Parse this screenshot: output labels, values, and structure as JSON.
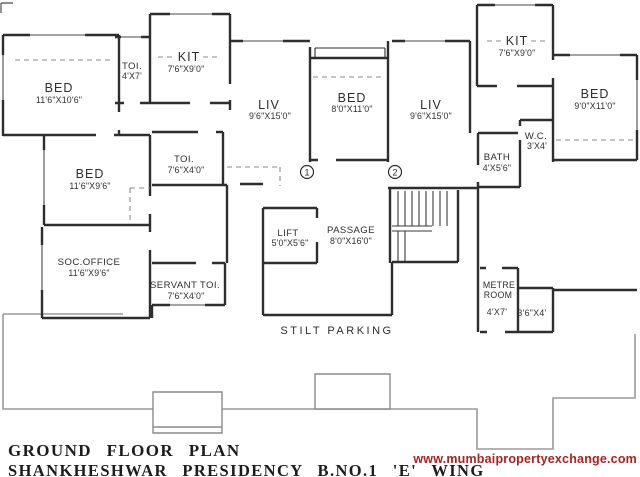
{
  "plan": {
    "rooms": {
      "bed_top_left": {
        "name": "BED",
        "dims": "11'6\"X10'6\""
      },
      "toi_top_left": {
        "name": "TOI.",
        "dims": "4'X7'"
      },
      "kitchen_left": {
        "name": "KIT",
        "dims": "7'6\"X9'0\""
      },
      "living_left": {
        "name": "LIV",
        "dims": "9'6\"X15'0\""
      },
      "bed_mid": {
        "name": "BED",
        "dims": "8'0\"X11'0\""
      },
      "living_right": {
        "name": "LIV",
        "dims": "9'6\"X15'0\""
      },
      "kitchen_right": {
        "name": "KIT",
        "dims": "7'6\"X9'0\""
      },
      "bed_right": {
        "name": "BED",
        "dims": "9'0\"X11'0\""
      },
      "wc": {
        "name": "W.C.",
        "dims": "3'X4'"
      },
      "bath": {
        "name": "BATH",
        "dims": "4'X5'6\""
      },
      "bed_left": {
        "name": "BED",
        "dims": "11'6\"X9'6\""
      },
      "toi_mid": {
        "name": "TOI.",
        "dims": "7'6\"X4'0\""
      },
      "soc_office": {
        "name": "SOC.OFFICE",
        "dims": "11'6\"X9'6\""
      },
      "servant_toi": {
        "name": "SERVANT TOI.",
        "dims": "7'6\"X4'0\""
      },
      "lift": {
        "name": "LIFT",
        "dims": "5'0\"X5'6\""
      },
      "passage": {
        "name": "PASSAGE",
        "dims": "8'0\"X16'0\""
      },
      "metre_room": {
        "name_line1": "METRE",
        "name_line2": "ROOM",
        "dims": "4'X7'"
      },
      "store": {
        "dims": "3'6\"X4'"
      }
    },
    "area_labels": {
      "stilt_parking": "STILT PARKING"
    },
    "unit_markers": {
      "one": "1",
      "two": "2"
    }
  },
  "footer": {
    "plan_title": "GROUND FLOOR PLAN",
    "project_title": "SHANKHESHWAR PRESIDENCY B.NO.1 'E' WING",
    "website": "www.mumbaipropertyexchange.com"
  },
  "colors": {
    "wall": "#2e2e2e",
    "boundary": "#9a9a9a",
    "website_text": "#aa2222"
  }
}
